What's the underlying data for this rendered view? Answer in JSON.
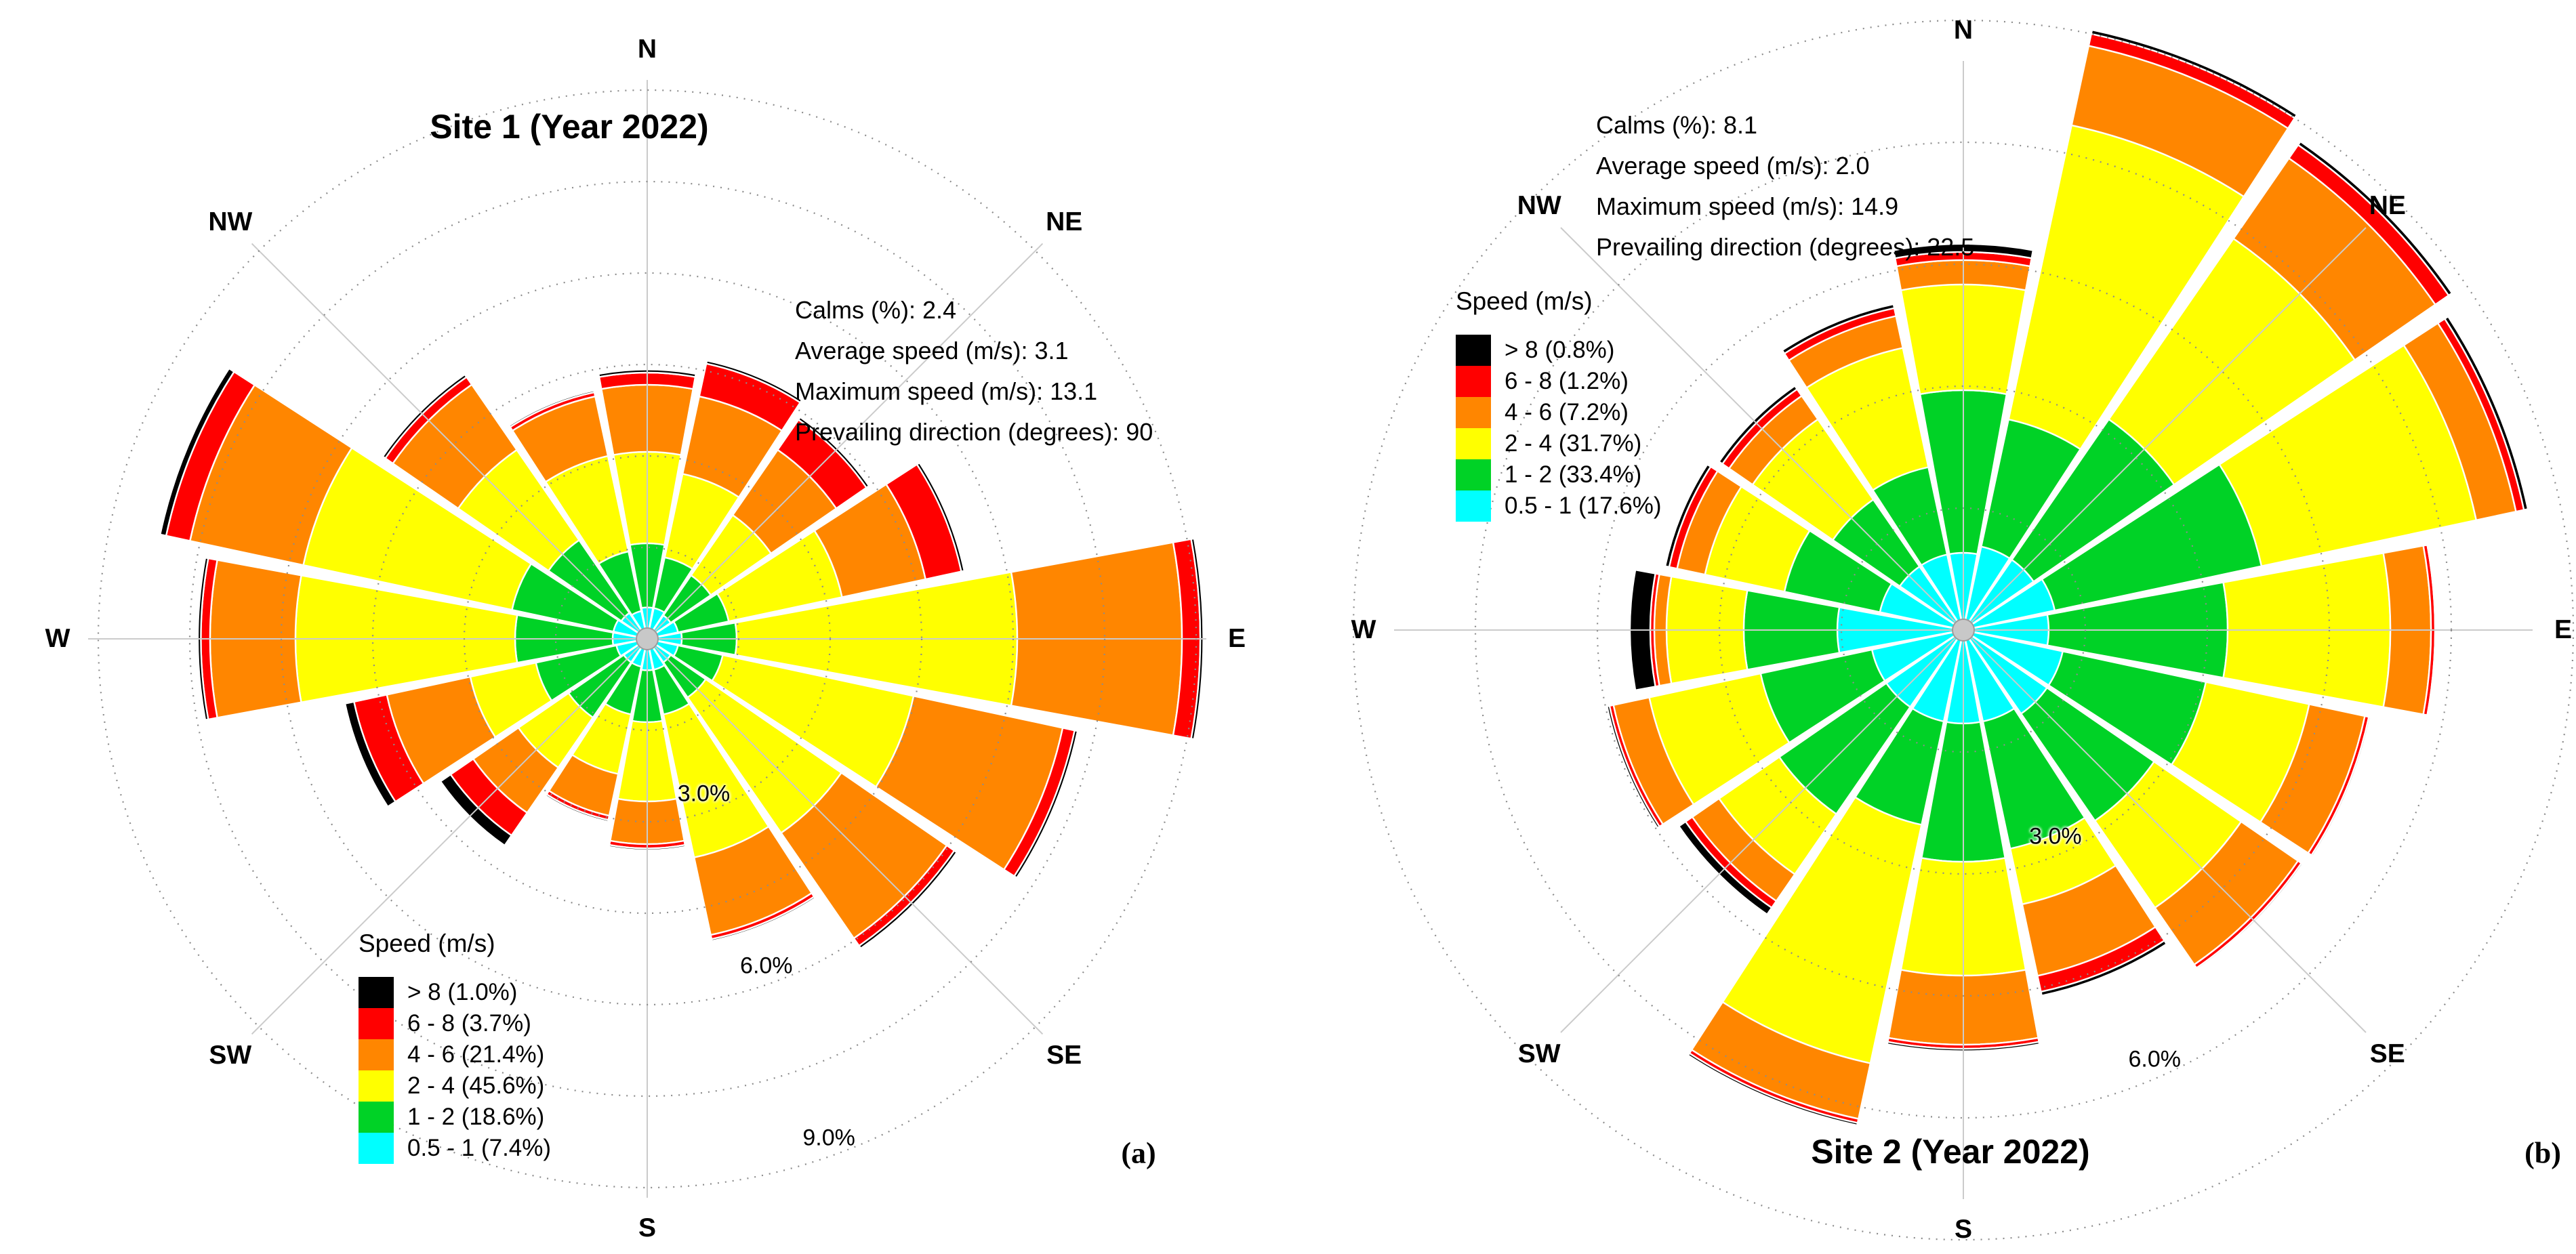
{
  "figure": {
    "panel_a_marker": "(a)",
    "panel_b_marker": "(b)"
  },
  "colors": {
    "bin_0_5_1": "#00FFFF",
    "bin_1_2": "#00D226",
    "bin_2_4": "#FFFF00",
    "bin_4_6": "#FF8600",
    "bin_6_8": "#FF0000",
    "bin_gt8": "#000000",
    "grid_ring": "#8c8c8c",
    "spoke": "#cbcbcb",
    "hub_fill": "#c8c8c8",
    "hub_stroke": "#9b9b9b"
  },
  "chart_data": [
    {
      "type": "windrose",
      "panel": "a",
      "title": "Site 1 (Year 2022)",
      "stats": [
        "Calms (%): 2.4",
        "Average speed (m/s): 3.1",
        "Maximum speed (m/s): 13.1",
        "Prevailing direction (degrees): 90"
      ],
      "legend_title": "Speed (m/s)",
      "legend": [
        {
          "label": "> 8 (1.0%)",
          "color_key": "bin_gt8"
        },
        {
          "label": "6 - 8 (3.7%)",
          "color_key": "bin_6_8"
        },
        {
          "label": "4 - 6 (21.4%)",
          "color_key": "bin_4_6"
        },
        {
          "label": "2 - 4 (45.6%)",
          "color_key": "bin_2_4"
        },
        {
          "label": "1 - 2 (18.6%)",
          "color_key": "bin_1_2"
        },
        {
          "label": "0.5 - 1 (7.4%)",
          "color_key": "bin_0_5_1"
        }
      ],
      "compass_labels": [
        "N",
        "NE",
        "E",
        "SE",
        "S",
        "SW",
        "W",
        "NW"
      ],
      "ring_labels": [
        "3.0%",
        "6.0%",
        "9.0%"
      ],
      "rings_pct": [
        1.5,
        3,
        4.5,
        6,
        7.5,
        9
      ],
      "axis": {
        "unit": "%",
        "max_pct": 9.75
      },
      "bins_inner_to_outer": [
        "0.5 - 1",
        "1 - 2",
        "2 - 4",
        "4 - 6",
        "6 - 8",
        "> 8"
      ],
      "by_direction": [
        {
          "dir": "N",
          "widths_pct": [
            0.45,
            1.05,
            1.5,
            1.1,
            0.2,
            0.05
          ]
        },
        {
          "dir": "NNE",
          "widths_pct": [
            0.45,
            0.85,
            1.4,
            1.3,
            0.55,
            0.05
          ]
        },
        {
          "dir": "NE",
          "widths_pct": [
            0.4,
            0.8,
            1.2,
            1.3,
            0.6,
            0.05
          ]
        },
        {
          "dir": "ENE",
          "widths_pct": [
            0.45,
            0.85,
            1.9,
            1.4,
            0.6,
            0.05
          ]
        },
        {
          "dir": "E",
          "widths_pct": [
            0.5,
            0.9,
            4.6,
            2.7,
            0.3,
            0.05
          ]
        },
        {
          "dir": "ESE",
          "widths_pct": [
            0.45,
            0.75,
            3.2,
            2.5,
            0.2,
            0.05
          ]
        },
        {
          "dir": "SE",
          "widths_pct": [
            0.4,
            0.7,
            2.7,
            2.1,
            0.15,
            0.05
          ]
        },
        {
          "dir": "SSE",
          "widths_pct": [
            0.45,
            0.75,
            2.4,
            1.3,
            0.07,
            0.03
          ]
        },
        {
          "dir": "S",
          "widths_pct": [
            0.45,
            0.85,
            1.3,
            0.7,
            0.07,
            0.03
          ]
        },
        {
          "dir": "SSW",
          "widths_pct": [
            0.4,
            0.8,
            1.0,
            0.7,
            0.07,
            0.03
          ]
        },
        {
          "dir": "SW",
          "widths_pct": [
            0.4,
            1.1,
            1.0,
            0.9,
            0.45,
            0.2
          ]
        },
        {
          "dir": "WSW",
          "widths_pct": [
            0.45,
            1.35,
            1.1,
            1.4,
            0.55,
            0.15
          ]
        },
        {
          "dir": "W",
          "widths_pct": [
            0.5,
            1.6,
            3.6,
            1.4,
            0.15,
            0.05
          ]
        },
        {
          "dir": "WNW",
          "widths_pct": [
            0.5,
            1.7,
            3.5,
            1.9,
            0.4,
            0.1
          ]
        },
        {
          "dir": "NW",
          "widths_pct": [
            0.45,
            1.45,
            1.8,
            1.3,
            0.15,
            0.05
          ]
        },
        {
          "dir": "NNW",
          "widths_pct": [
            0.4,
            1.0,
            1.6,
            1.0,
            0.07,
            0.03
          ]
        }
      ]
    },
    {
      "type": "windrose",
      "panel": "b",
      "title": "Site 2 (Year 2022)",
      "stats": [
        "Calms (%): 8.1",
        "Average speed (m/s): 2.0",
        "Maximum speed (m/s): 14.9",
        "Prevailing direction (degrees): 22.5"
      ],
      "legend_title": "Speed (m/s)",
      "legend": [
        {
          "label": "> 8 (0.8%)",
          "color_key": "bin_gt8"
        },
        {
          "label": "6 - 8 (1.2%)",
          "color_key": "bin_6_8"
        },
        {
          "label": "4 - 6 (7.2%)",
          "color_key": "bin_4_6"
        },
        {
          "label": "2 - 4 (31.7%)",
          "color_key": "bin_2_4"
        },
        {
          "label": "1 - 2 (33.4%)",
          "color_key": "bin_1_2"
        },
        {
          "label": "0.5 - 1 (17.6%)",
          "color_key": "bin_0_5_1"
        }
      ],
      "compass_labels": [
        "N",
        "NE",
        "E",
        "SE",
        "S",
        "SW",
        "W",
        "NW"
      ],
      "ring_labels": [
        "3.0%",
        "6.0%"
      ],
      "rings_pct": [
        1.5,
        3,
        4.5,
        6,
        7.5
      ],
      "axis": {
        "unit": "%",
        "max_pct": 7.5
      },
      "bins_inner_to_outer": [
        "0.5 - 1",
        "1 - 2",
        "2 - 4",
        "4 - 6",
        "6 - 8",
        "> 8"
      ],
      "by_direction": [
        {
          "dir": "N",
          "widths_pct": [
            0.9,
            2.0,
            1.3,
            0.3,
            0.1,
            0.1
          ]
        },
        {
          "dir": "NNE",
          "widths_pct": [
            1.0,
            1.6,
            3.7,
            1.0,
            0.15,
            0.05
          ]
        },
        {
          "dir": "NE",
          "widths_pct": [
            1.0,
            2.1,
            2.7,
            1.2,
            0.2,
            0.05
          ]
        },
        {
          "dir": "ENE",
          "widths_pct": [
            1.1,
            2.6,
            2.7,
            0.5,
            0.1,
            0.05
          ]
        },
        {
          "dir": "E",
          "widths_pct": [
            1.0,
            2.2,
            2.0,
            0.5,
            0.05,
            0.02
          ]
        },
        {
          "dir": "ESE",
          "widths_pct": [
            1.2,
            1.8,
            1.3,
            0.7,
            0.05,
            0.02
          ]
        },
        {
          "dir": "SE",
          "widths_pct": [
            1.2,
            1.6,
            1.3,
            0.85,
            0.05,
            0.02
          ]
        },
        {
          "dir": "SSE",
          "widths_pct": [
            1.1,
            1.6,
            0.7,
            0.9,
            0.2,
            0.05
          ]
        },
        {
          "dir": "S",
          "widths_pct": [
            1.1,
            1.7,
            1.4,
            0.85,
            0.05,
            0.03
          ]
        },
        {
          "dir": "SSW",
          "widths_pct": [
            1.1,
            1.3,
            3.0,
            0.7,
            0.05,
            0.03
          ]
        },
        {
          "dir": "SW",
          "widths_pct": [
            1.1,
            1.6,
            0.9,
            0.4,
            0.1,
            0.1
          ]
        },
        {
          "dir": "WSW",
          "widths_pct": [
            1.1,
            1.4,
            1.4,
            0.45,
            0.05,
            0.03
          ]
        },
        {
          "dir": "W",
          "widths_pct": [
            1.5,
            1.15,
            0.95,
            0.15,
            0.05,
            0.25
          ]
        },
        {
          "dir": "WNW",
          "widths_pct": [
            1.0,
            1.2,
            1.0,
            0.35,
            0.1,
            0.05
          ]
        },
        {
          "dir": "NW",
          "widths_pct": [
            0.9,
            1.0,
            1.2,
            0.35,
            0.1,
            0.05
          ]
        },
        {
          "dir": "NNW",
          "widths_pct": [
            0.9,
            1.1,
            1.5,
            0.4,
            0.1,
            0.05
          ]
        }
      ]
    }
  ]
}
